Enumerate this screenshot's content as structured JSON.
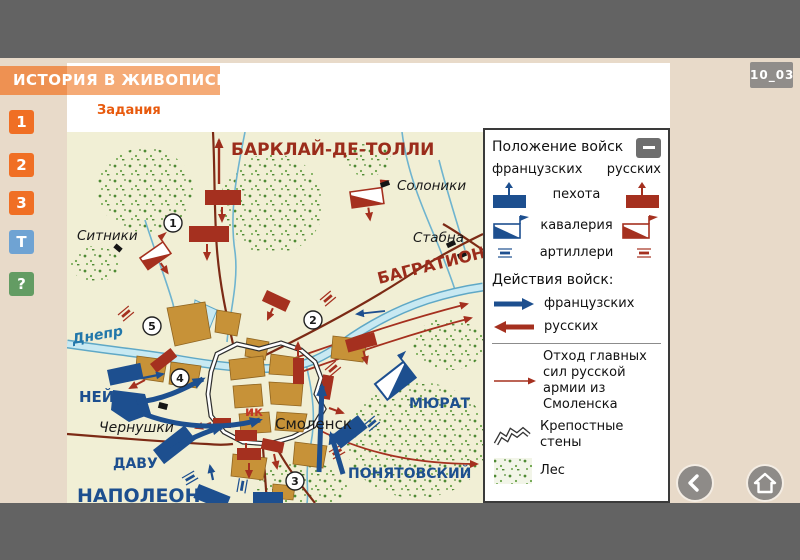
{
  "window": {
    "code_badge": "10_03"
  },
  "header": {
    "title": "ИСТОРИЯ В ЖИВОПИСИ",
    "section": "Задания"
  },
  "sidebar": {
    "buttons": [
      {
        "label": "1"
      },
      {
        "label": "2"
      },
      {
        "label": "3"
      },
      {
        "label": "T"
      },
      {
        "label": "?"
      }
    ]
  },
  "map": {
    "labels": {
      "barclay": "БАРКЛАЙ-ДЕ-ТОЛЛИ",
      "bagration": "БАГРАТИОН",
      "ney": "НЕЙ",
      "davout": "ДАВУ",
      "napoleon": "НАПОЛЕОН",
      "murat": "МЮРАТ",
      "poniatowski": "ПОНЯТОВСКИЙ",
      "sitniki": "Ситники",
      "soloniki": "Солоники",
      "stabna": "Стабна",
      "chernushki": "Чернушки",
      "smolensk": "Смоленск",
      "dnieper": "Днепр",
      "wall_fragment": "ик"
    },
    "markers": [
      "1",
      "2",
      "3",
      "4",
      "5"
    ]
  },
  "legend": {
    "title": "Положение войск",
    "columns": {
      "french": "французских",
      "russian": "русских"
    },
    "unit_rows": [
      {
        "label": "пехота"
      },
      {
        "label": "кавалерия"
      },
      {
        "label": "артиллери"
      }
    ],
    "actions_title": "Действия войск:",
    "action_rows": [
      {
        "label": "французских"
      },
      {
        "label": "русских"
      }
    ],
    "retreat_label": "Отход главных сил русской армии из Смоленска",
    "walls_label": "Крепостные стены",
    "forest_label": "Лес"
  },
  "nav": {
    "back_icon": "chevron-left",
    "home_icon": "home",
    "collapse_icon": "minus"
  },
  "colors": {
    "frame_gray": "#636363",
    "page_beige": "#e8dac9",
    "header_orange": "#f5ab77",
    "task_button_orange": "#f06f24",
    "t_button_blue": "#6fa3d3",
    "help_button_green": "#639c63",
    "accent_orange": "#e85a0d",
    "french_blue": "#1d4f8f",
    "russian_red": "#a5301f",
    "label_dark_red": "#9b2c1b",
    "road_brown": "#7c2a15",
    "river_blue": "#8ec6dc",
    "badge_gray": "#908d8a"
  }
}
